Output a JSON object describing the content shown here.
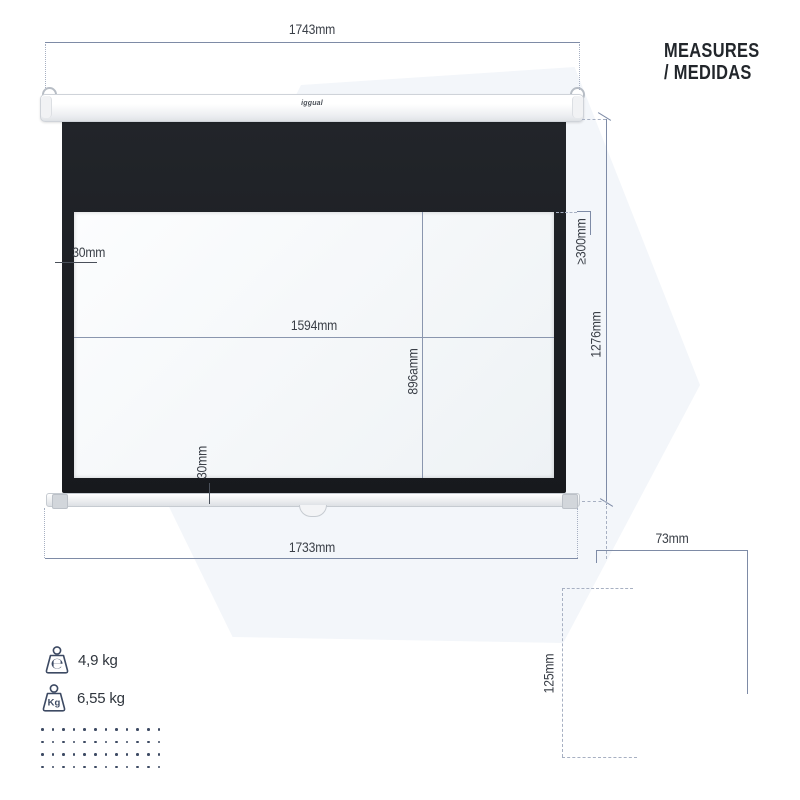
{
  "title": {
    "line1": "MEASURES",
    "line2": "/ MEDIDAS"
  },
  "screen": {
    "brand": "iggual"
  },
  "dims": {
    "top_width": "1743mm",
    "bottom_width": "1733mm",
    "view_width": "1594mm",
    "view_height": "896amm",
    "left_border": "30mm",
    "bottom_border": "30mm",
    "black_drop": "≥300mm",
    "total_height": "1276mm",
    "case_width": "73mm",
    "case_height": "125mm"
  },
  "weights": [
    {
      "icon": "net-weight-icon",
      "symbol": "℮",
      "value": "4,9 kg"
    },
    {
      "icon": "kg-weight-icon",
      "symbol": "Kg",
      "value": "6,55 kg"
    }
  ],
  "decor": {
    "dot_grid": {
      "rows": 4,
      "cols": 12
    }
  },
  "colors": {
    "dim_line": "#7e8ba6",
    "dim_text": "#3a3f47",
    "screen_black": "#1c1f24",
    "accent_navy": "#3d4a63",
    "watermark": "#f3f6fa",
    "photo_black": "#111316"
  }
}
